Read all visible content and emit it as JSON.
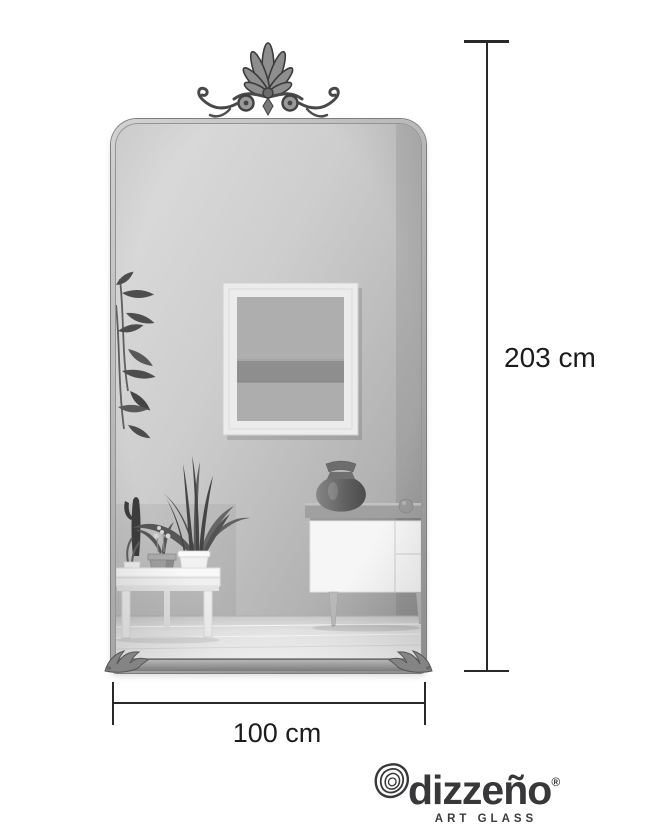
{
  "dimensions": {
    "height_label": "203 cm",
    "width_label": "100 cm"
  },
  "logo": {
    "brand": "dizzeño",
    "registered": "®",
    "tagline": "ART GLASS"
  },
  "icons": {
    "crest": "ornate-palmette-scroll-crest",
    "corner_flourish": "acanthus-leaf-corner",
    "logo_mark": "concentric-pebble-rings"
  },
  "colors": {
    "background": "#ffffff",
    "dimension_line": "#282828",
    "label_text": "#1c1c1c",
    "logo_text": "#38383a",
    "frame_metal": "#a8a8a8",
    "wall_light": "#dedede",
    "wall_dark": "#9c9c9c",
    "floor": "#f2f2f2",
    "vase": "#5f5f5f"
  }
}
